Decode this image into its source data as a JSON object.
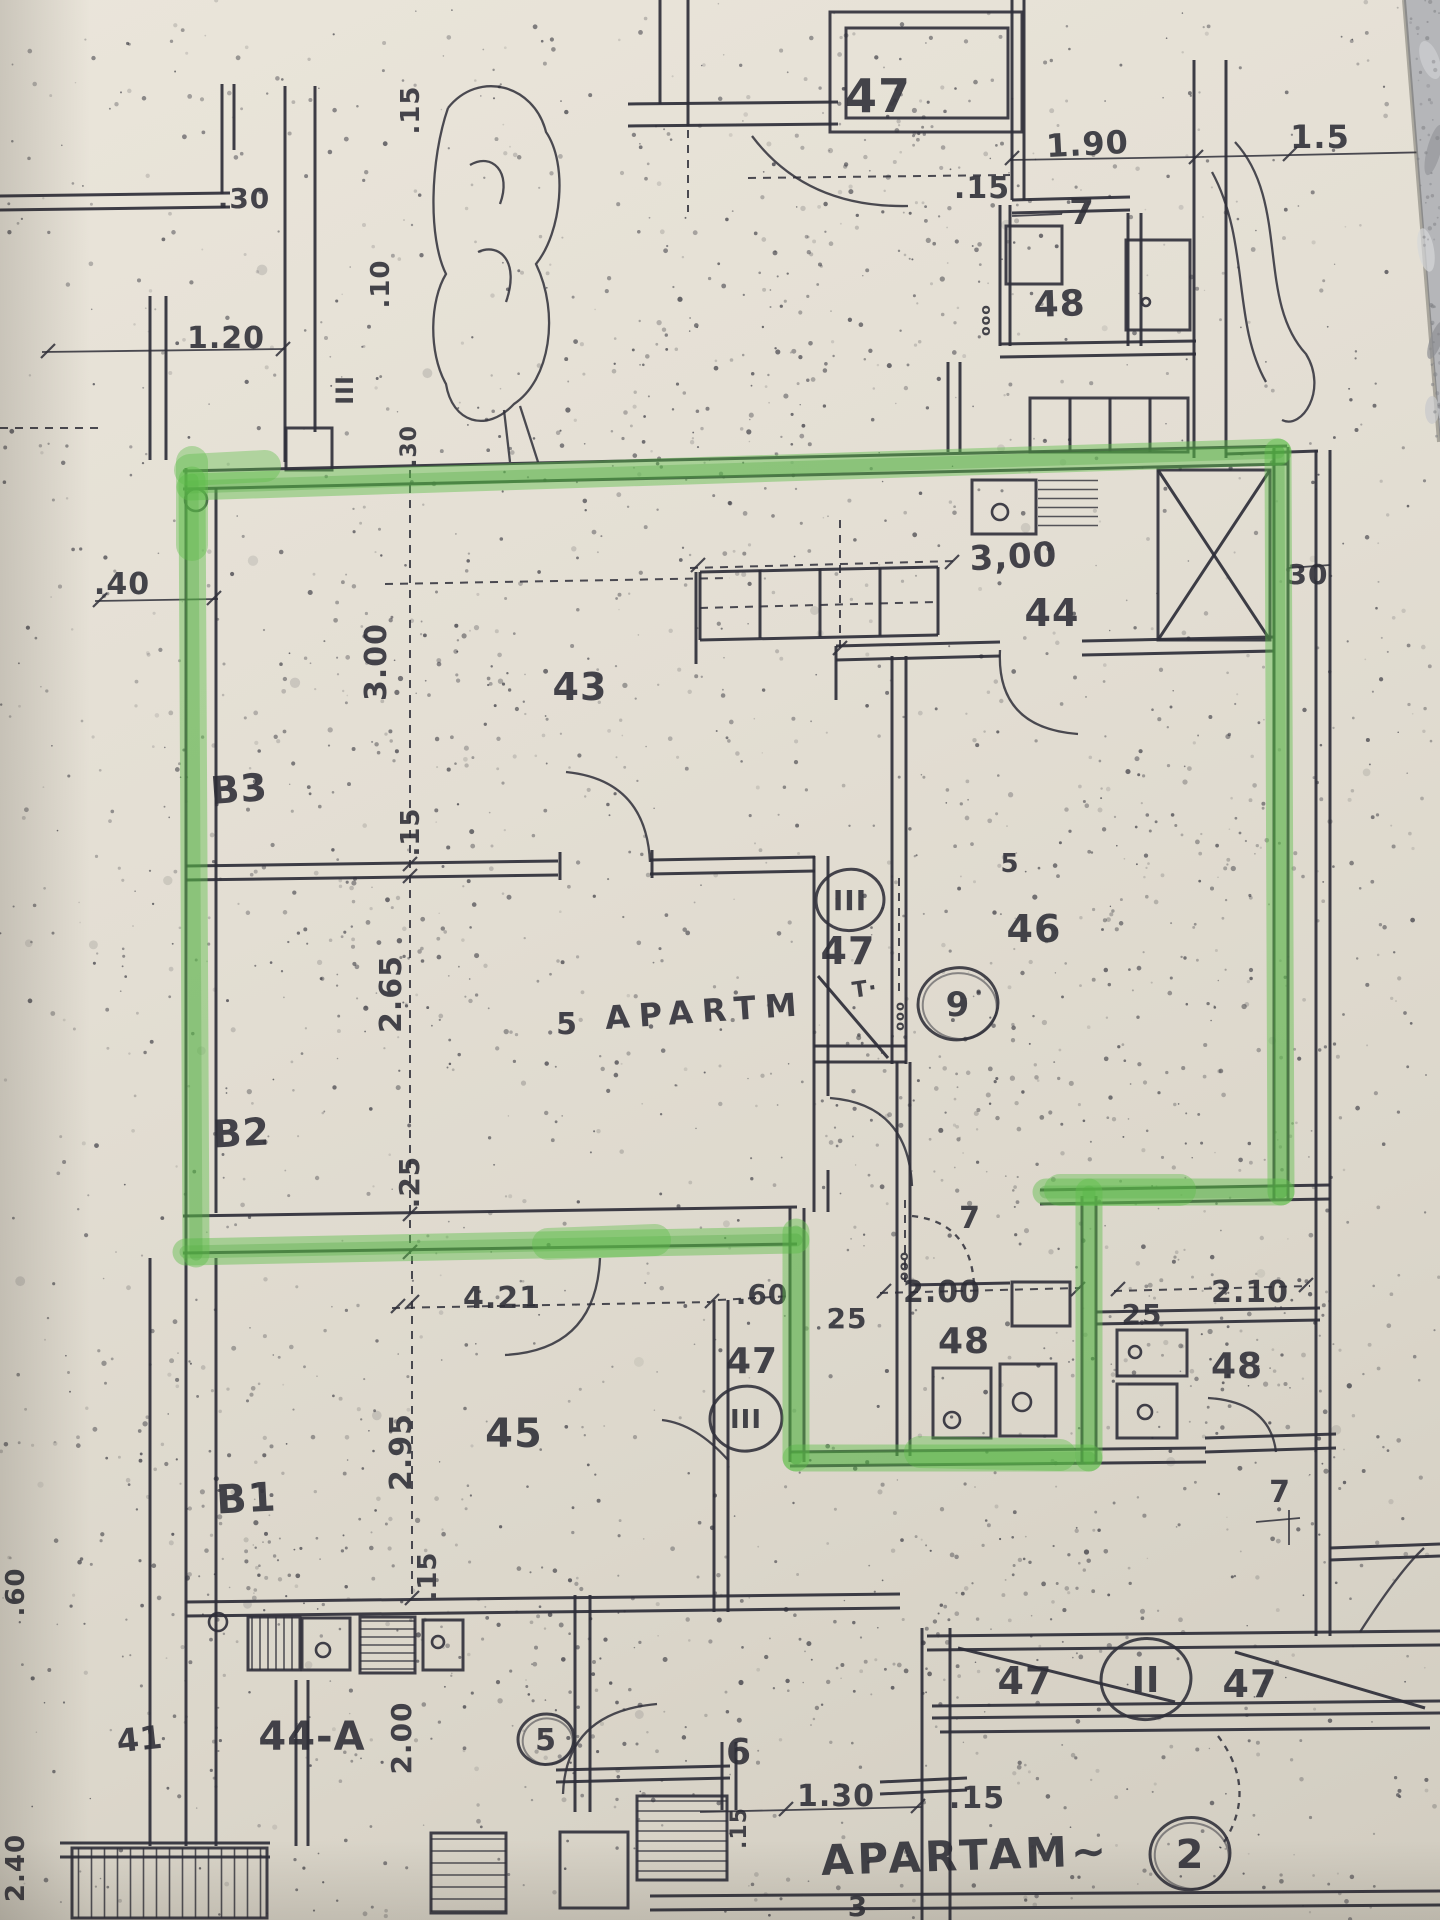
{
  "document": {
    "type": "photographed floor plan photocopy",
    "paper_color": "#e2ddd1",
    "ink_color": "#2e2e38",
    "marble_color": "#b5b6b9",
    "highlight": {
      "color": "#5fbe4c",
      "outlined_unit_text": "5 APARTM",
      "unit_number_in_circle": "9"
    },
    "labels": [
      {
        "text": "47",
        "x": 878,
        "y": 112,
        "size": 46
      },
      {
        "text": ".15",
        "x": 982,
        "y": 198,
        "size": 30
      },
      {
        "text": "1.90",
        "x": 1088,
        "y": 155,
        "size": 32,
        "rot": -3
      },
      {
        "text": "1.5",
        "x": 1320,
        "y": 148,
        "size": 32
      },
      {
        "text": "7",
        "x": 1082,
        "y": 224,
        "size": 36
      },
      {
        "text": "48",
        "x": 1060,
        "y": 316,
        "size": 36,
        "rot": -2
      },
      {
        "text": "ooo",
        "x": 990,
        "y": 320,
        "size": 14,
        "rot": -90
      },
      {
        "text": ".30",
        "x": 244,
        "y": 208,
        "size": 28
      },
      {
        "text": ".15",
        "x": 419,
        "y": 110,
        "size": 26,
        "rot": -90
      },
      {
        "text": ".10",
        "x": 389,
        "y": 284,
        "size": 26,
        "rot": -90
      },
      {
        "text": "III",
        "x": 353,
        "y": 390,
        "size": 24,
        "rot": -90
      },
      {
        "text": "1.20",
        "x": 226,
        "y": 348,
        "size": 30
      },
      {
        "text": ".30",
        "x": 416,
        "y": 446,
        "size": 22,
        "rot": -90
      },
      {
        "text": ".40",
        "x": 122,
        "y": 594,
        "size": 30
      },
      {
        "text": "3,00",
        "x": 1014,
        "y": 568,
        "size": 34,
        "rot": -3
      },
      {
        "text": "30",
        "x": 1308,
        "y": 584,
        "size": 28
      },
      {
        "text": "44",
        "x": 1052,
        "y": 626,
        "size": 38
      },
      {
        "text": "43",
        "x": 580,
        "y": 700,
        "size": 38
      },
      {
        "text": "3.00",
        "x": 386,
        "y": 662,
        "size": 30,
        "rot": -90
      },
      {
        "text": "B3",
        "x": 240,
        "y": 802,
        "size": 38,
        "rot": -4
      },
      {
        "text": ".15",
        "x": 419,
        "y": 832,
        "size": 26,
        "rot": -90
      },
      {
        "text": "5",
        "x": 1010,
        "y": 872,
        "size": 26
      },
      {
        "text": "III",
        "x": 850,
        "y": 910,
        "size": 28,
        "circle": 34
      },
      {
        "text": "47",
        "x": 848,
        "y": 964,
        "size": 38
      },
      {
        "text": "T·",
        "x": 866,
        "y": 996,
        "size": 22,
        "rot": -8
      },
      {
        "text": "9",
        "x": 958,
        "y": 1016,
        "size": 34,
        "circle": 40,
        "hand": true
      },
      {
        "text": "46",
        "x": 1034,
        "y": 942,
        "size": 38
      },
      {
        "text": "ooo",
        "x": 904,
        "y": 1016,
        "size": 13,
        "rot": -90
      },
      {
        "text": "5",
        "x": 567,
        "y": 1034,
        "size": 30
      },
      {
        "text": "APARTM",
        "x": 706,
        "y": 1022,
        "size": 32,
        "rot": -4,
        "spread": 9
      },
      {
        "text": "2.65",
        "x": 401,
        "y": 994,
        "size": 30,
        "rot": -90
      },
      {
        "text": "B2",
        "x": 242,
        "y": 1146,
        "size": 38,
        "rot": -3
      },
      {
        "text": ".25",
        "x": 419,
        "y": 1182,
        "size": 28,
        "rot": -90
      },
      {
        "text": "7",
        "x": 970,
        "y": 1228,
        "size": 30
      },
      {
        "text": "ooo",
        "x": 908,
        "y": 1266,
        "size": 13,
        "rot": -90
      },
      {
        "text": "4.21",
        "x": 502,
        "y": 1308,
        "size": 30
      },
      {
        "text": ".60",
        "x": 762,
        "y": 1304,
        "size": 28
      },
      {
        "text": "25",
        "x": 847,
        "y": 1328,
        "size": 28
      },
      {
        "text": "2.00",
        "x": 942,
        "y": 1302,
        "size": 30
      },
      {
        "text": "48",
        "x": 964,
        "y": 1353,
        "size": 36
      },
      {
        "text": "2.10",
        "x": 1250,
        "y": 1302,
        "size": 30
      },
      {
        "text": "25",
        "x": 1142,
        "y": 1324,
        "size": 28
      },
      {
        "text": "48",
        "x": 1237,
        "y": 1378,
        "size": 36
      },
      {
        "text": "47",
        "x": 752,
        "y": 1373,
        "size": 36
      },
      {
        "text": "III",
        "x": 746,
        "y": 1428,
        "size": 26,
        "circle": 36
      },
      {
        "text": "45",
        "x": 514,
        "y": 1447,
        "size": 40
      },
      {
        "text": "2.95",
        "x": 411,
        "y": 1452,
        "size": 30,
        "rot": -90
      },
      {
        "text": "B1",
        "x": 247,
        "y": 1512,
        "size": 40,
        "rot": -3
      },
      {
        "text": ".15",
        "x": 436,
        "y": 1576,
        "size": 26,
        "rot": -90
      },
      {
        "text": ".60",
        "x": 24,
        "y": 1592,
        "size": 26,
        "rot": -90
      },
      {
        "text": "41",
        "x": 141,
        "y": 1750,
        "size": 32,
        "rot": -6
      },
      {
        "text": "44-A",
        "x": 312,
        "y": 1750,
        "size": 40
      },
      {
        "text": "2.00",
        "x": 411,
        "y": 1738,
        "size": 28,
        "rot": -90
      },
      {
        "text": "5",
        "x": 546,
        "y": 1750,
        "size": 30,
        "circle": 28,
        "hand": true
      },
      {
        "text": "6",
        "x": 739,
        "y": 1764,
        "size": 36
      },
      {
        "text": ".15",
        "x": 746,
        "y": 1828,
        "size": 22,
        "rot": -90
      },
      {
        "text": "1.30",
        "x": 836,
        "y": 1806,
        "size": 30
      },
      {
        "text": ".15",
        "x": 977,
        "y": 1808,
        "size": 30
      },
      {
        "text": "APARTAM~",
        "x": 966,
        "y": 1870,
        "size": 42,
        "rot": -2,
        "spread": 4
      },
      {
        "text": "2",
        "x": 1190,
        "y": 1868,
        "size": 40,
        "circle": 40,
        "hand": true
      },
      {
        "text": "47",
        "x": 1025,
        "y": 1694,
        "size": 38
      },
      {
        "text": "II",
        "x": 1146,
        "y": 1692,
        "size": 36,
        "circle": 45
      },
      {
        "text": "47",
        "x": 1250,
        "y": 1697,
        "size": 38
      },
      {
        "text": "7",
        "x": 1280,
        "y": 1502,
        "size": 30
      },
      {
        "text": "2.40",
        "x": 24,
        "y": 1868,
        "size": 26,
        "rot": -90
      },
      {
        "text": "3",
        "x": 858,
        "y": 1916,
        "size": 28
      }
    ]
  }
}
